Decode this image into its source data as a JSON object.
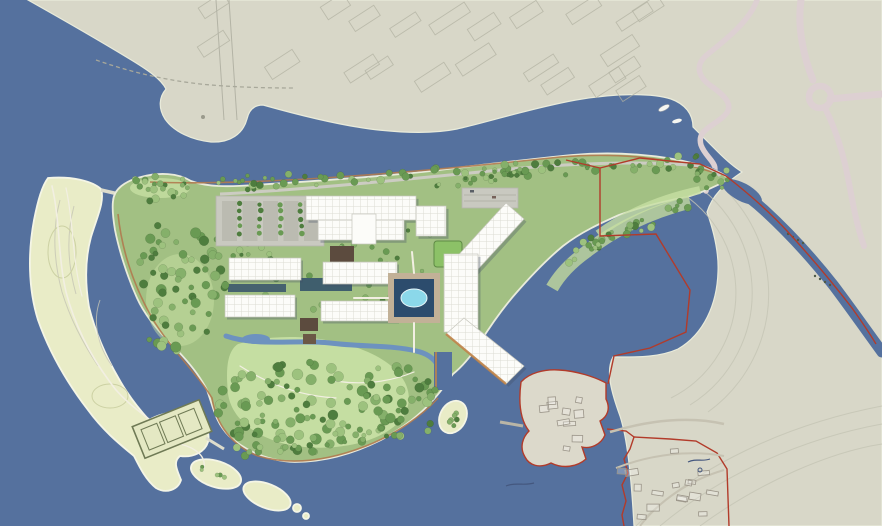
{
  "scene": {
    "title": "Waterfront resort master plan — aerial site rendering",
    "type": "architectural site plan",
    "features": [
      "mainland-urban-area",
      "north-channel",
      "resort-peninsula",
      "central-hotel-complex",
      "villa-rows",
      "circular-pool-plaza",
      "event-lawn",
      "parking-lot",
      "pier-buildings",
      "lagoon-bay",
      "sand-spit",
      "tennis-courts",
      "existing-village",
      "river",
      "roundabout",
      "serpentine-road",
      "property-boundary",
      "boats",
      "islets",
      "park-forest"
    ]
  },
  "palette": {
    "water": "#55719e",
    "land": "#d8d7c8",
    "sand": "#e9ecc7",
    "sandEdge": "#f4f5e6",
    "islandEdge": "#e9ebdb",
    "park": "#a2c083",
    "lawn": "#c7dfa3",
    "eventLawn": "#8cc167",
    "treeDark": "#4e7d3e",
    "treeMid": "#699a53",
    "treeLight": "#85b06a",
    "bush": "#9dc27e",
    "building": "#fcfcf9",
    "buildingLine": "#c6c6bc",
    "shadow": "rgba(66,78,98,0.32)",
    "plazaTan": "#c2b197",
    "poolBasin": "#2c4c6d",
    "poolWater": "#8bd8ea",
    "roadPink": "#ddd0d2",
    "roadGray": "#ccccc2",
    "pathWhite": "#f2efe2",
    "pathTan": "#b07a4f",
    "boundaryRed": "#b23b2a",
    "stream": "#6d92bf",
    "shallow": "#bdd49c",
    "contour": "#c4c4b4",
    "blockLine": "#b1b1a2",
    "courtDark": "#5c4b3e",
    "waterCourt": "#3f5e6d",
    "dock": "#c08449",
    "parking": "#c9c9c0",
    "stall": "#bbbbb1",
    "villageLine": "#9a9488",
    "villageFill": "#dcd9cb",
    "tennisFill": "#e4e8c3",
    "tennisLine": "#6f7a55",
    "boat": "#f6f6f1"
  }
}
